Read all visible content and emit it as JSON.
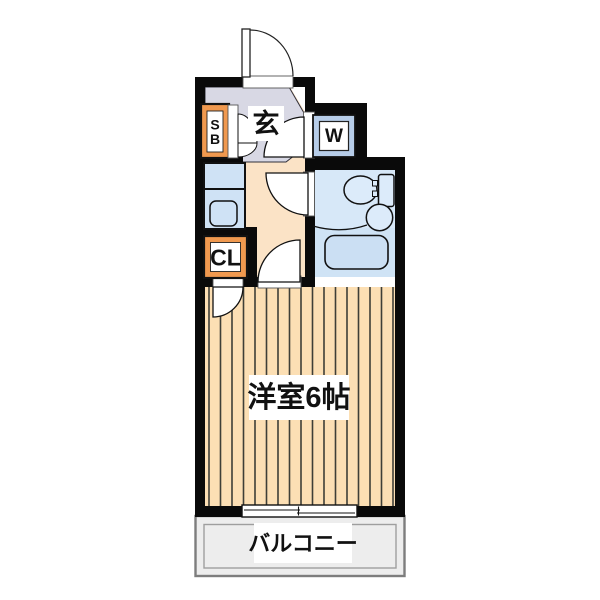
{
  "rooms": {
    "entrance": {
      "label": "玄"
    },
    "washer": {
      "label": "W"
    },
    "shoe_box": {
      "line1": "S",
      "line2": "B"
    },
    "closet": {
      "label": "CL"
    },
    "main_room": {
      "label": "洋室6帖"
    },
    "balcony": {
      "label": "バルコニー"
    }
  },
  "colors": {
    "wall": "#0a0a0a",
    "hall": "#fbe3c6",
    "genkan": "#d8d8e4",
    "water": "#d7e8f8",
    "wet": "#cfe3f5",
    "fixture": "#dcebfa",
    "tub": "#cbdff3",
    "kitchen": "#cfe2f5",
    "frame_blue": "#b7cde9",
    "orange": "#f0994f",
    "wood": "#fcdfb4",
    "stripe": "#3f3f37",
    "balcony_fill": "#ededed",
    "balcony_border": "#7d7d7d",
    "label_bg": "#ffffff"
  }
}
